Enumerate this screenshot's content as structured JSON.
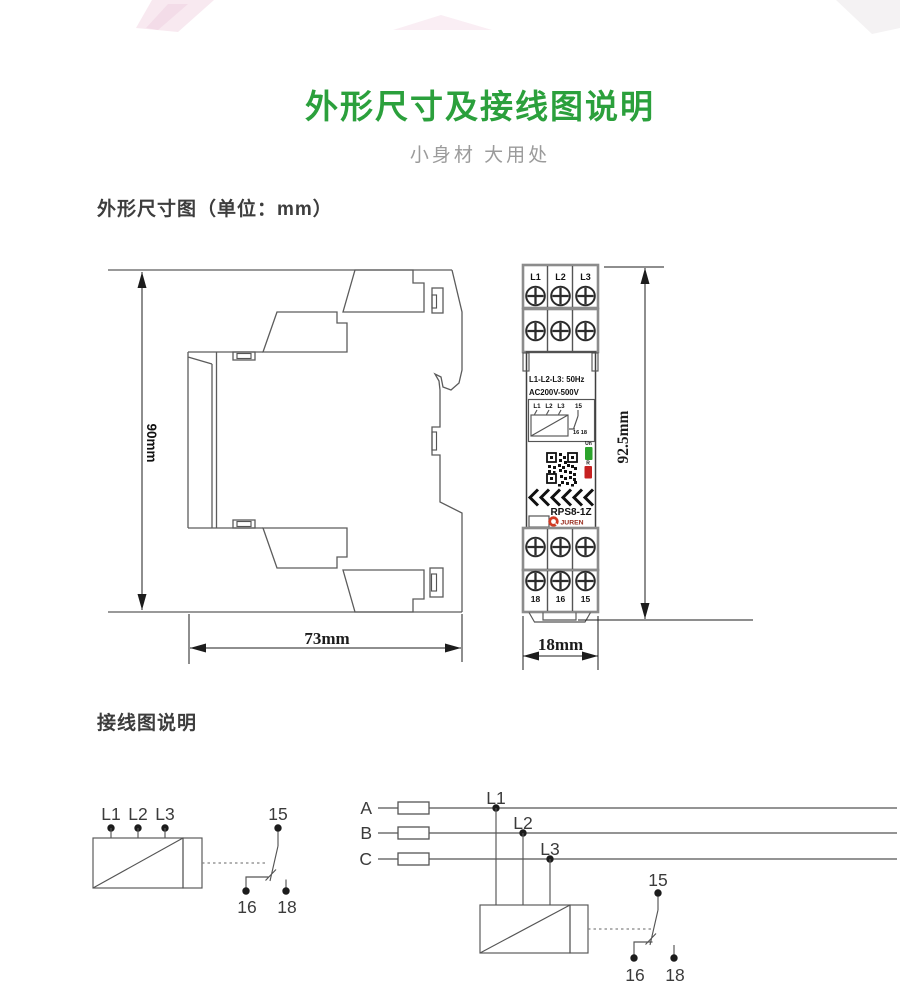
{
  "page": {
    "title": "外形尺寸及接线图说明",
    "subtitle": "小身材 大用处"
  },
  "sections": {
    "dimensions": "外形尺寸图（单位：mm）",
    "wiring": "接线图说明"
  },
  "dimension_labels": {
    "side_height": "90mm",
    "side_width": "73mm",
    "front_height": "92.5mm",
    "front_width": "18mm"
  },
  "device": {
    "top_terminals": [
      "L1",
      "L2",
      "L3"
    ],
    "bottom_terminals": [
      "18",
      "16",
      "15"
    ],
    "rating_line1": "L1-L2-L3: 50Hz",
    "rating_line2": "AC200V-500V",
    "mini_diagram": {
      "in1": "L1",
      "in2": "L2",
      "in3": "L3",
      "c15": "15",
      "c16_18": "16 18"
    },
    "led_un_label": "Un",
    "led_r_label": "R",
    "model": "RPS8-1Z",
    "brand": "JUREN",
    "colors": {
      "led_green": "#2ca42c",
      "led_red": "#c62121",
      "brand_red": "#d13b24"
    }
  },
  "wiring_left": {
    "in1": "L1",
    "in2": "L2",
    "in3": "L3",
    "c15": "15",
    "c16": "16",
    "c18": "18"
  },
  "wiring_right": {
    "phase_a": "A",
    "phase_b": "B",
    "phase_c": "C",
    "tap1": "L1",
    "tap2": "L2",
    "tap3": "L3",
    "c15": "15",
    "c16": "16",
    "c18": "18"
  },
  "colors": {
    "title_green": "#2ba03c"
  }
}
